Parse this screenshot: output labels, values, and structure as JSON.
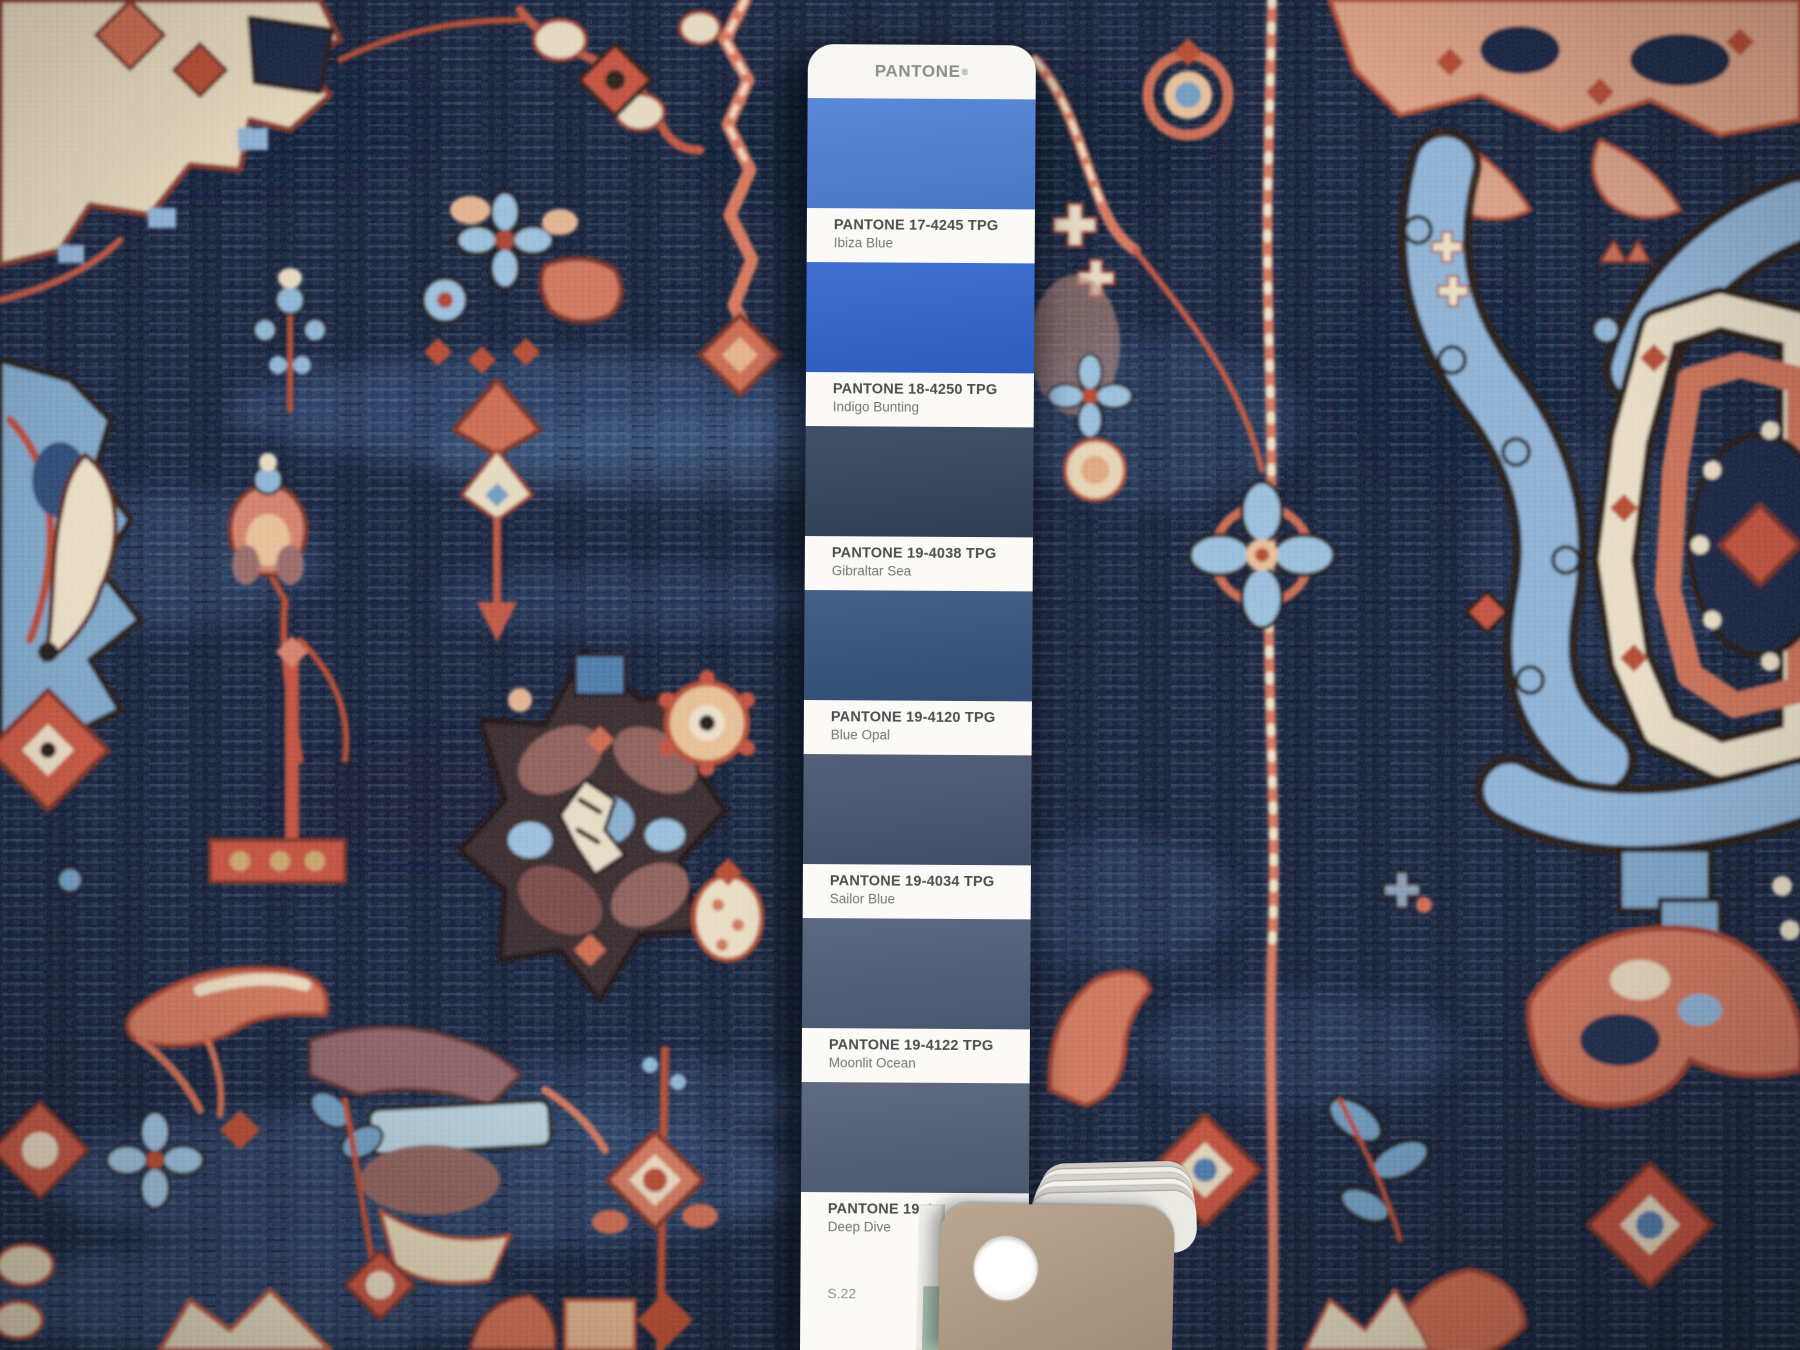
{
  "strip": {
    "brand": "PANTONE",
    "trademark": "®",
    "page_code": "S.22",
    "swatches": [
      {
        "code": "PANTONE 17-4245 TPG",
        "name": "Ibiza Blue",
        "color": "#4e7fd4"
      },
      {
        "code": "PANTONE 18-4250 TPG",
        "name": "Indigo Bunting",
        "color": "#3064cb"
      },
      {
        "code": "PANTONE 19-4038 TPG",
        "name": "Gibraltar Sea",
        "color": "#32435c"
      },
      {
        "code": "PANTONE 19-4120 TPG",
        "name": "Blue Opal",
        "color": "#35537d"
      },
      {
        "code": "PANTONE 19-4034 TPG",
        "name": "Sailor Blue",
        "color": "#475471"
      },
      {
        "code": "PANTONE 19-4122 TPG",
        "name": "Moonlit Ocean",
        "color": "#4e5d79"
      },
      {
        "code": "PANTONE 19-4",
        "name": "Deep Dive",
        "color": "#535f78"
      }
    ]
  },
  "fan_deck": {
    "top_card_color": "#ac9983",
    "edge_colors": [
      "#f1efe9",
      "#d0cdc6"
    ],
    "teal_edge_color": "#a9bfae",
    "binding_hole_color": "#ffffff"
  },
  "rug": {
    "field_color": "#16233f",
    "palette": {
      "coral": "#cd6a50",
      "red": "#b8492f",
      "dark_red": "#a03d2a",
      "peach": "#e4b48c",
      "cream": "#ecdfc4",
      "light_blue": "#8fb3d6",
      "steel_blue": "#3d5c88",
      "mauve": "#8f5f58",
      "outline": "#241812"
    }
  }
}
